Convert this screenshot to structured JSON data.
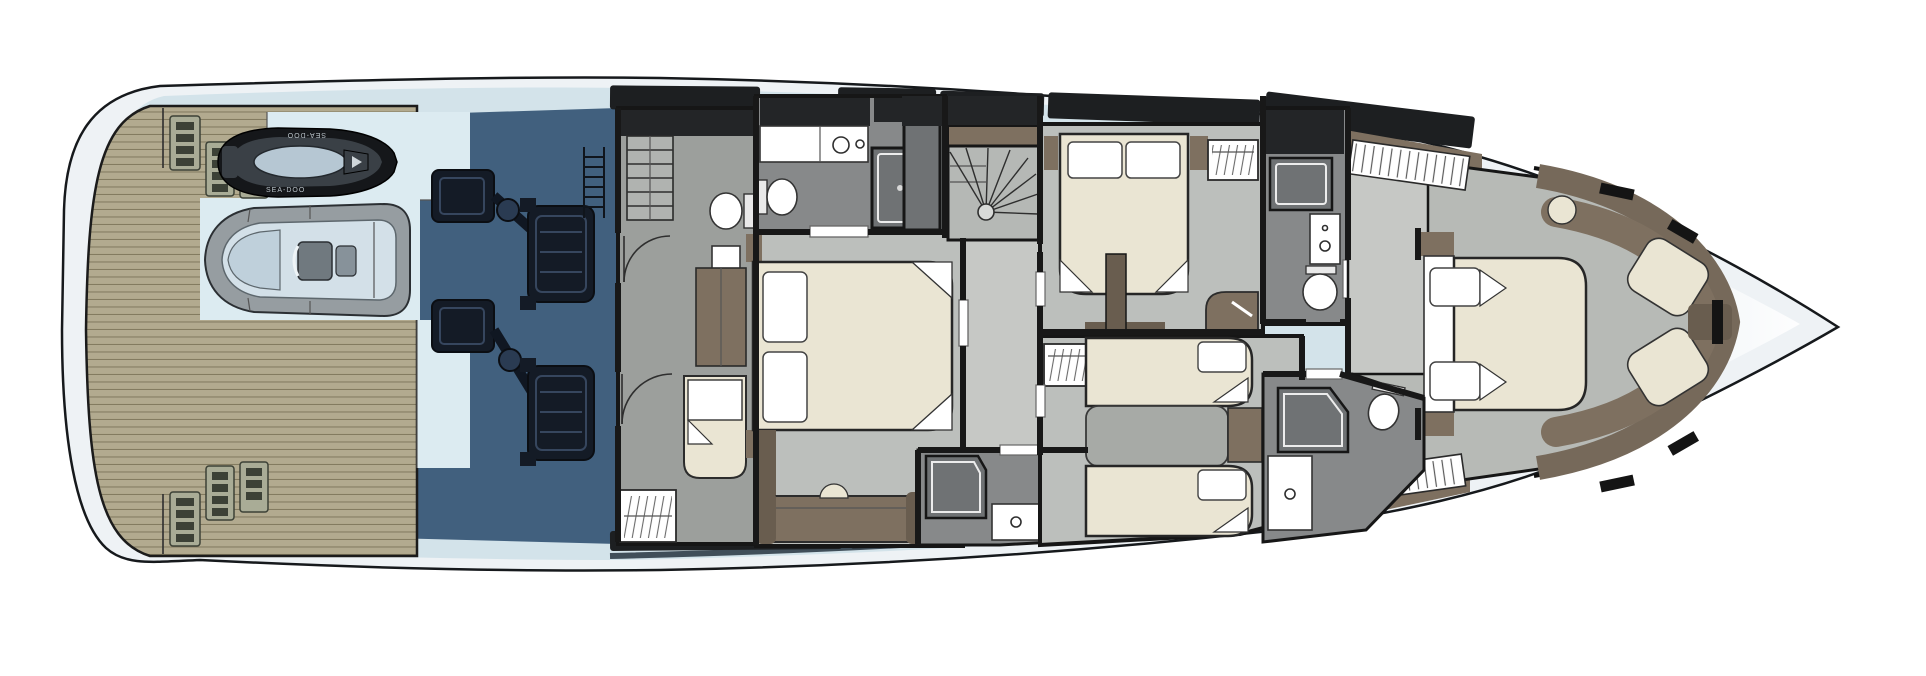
{
  "meta": {
    "title": "Yacht lower deck floor plan"
  },
  "labels": {
    "jetski_brand": "SEA-DOO"
  },
  "colors": {
    "bg": "#ffffff",
    "hull_fill": "#eef2f5",
    "hull_stroke": "#16191c",
    "deck_blue": "#d3e3ea",
    "garage_pale": "#dcebf1",
    "teak": "#b2aa8f",
    "teak_line": "#837b60",
    "louver_bg": "#a9ac96",
    "louver_slot": "#3c4136",
    "navy": "#41607e",
    "navy_dark": "#2c4257",
    "machinery": "#141b26",
    "machinery_mid": "#2a3b52",
    "jetski_black": "#15171a",
    "jetski_gray": "#3a4046",
    "jetski_seat": "#b6c7d3",
    "jetski_text": "#b9c2c8",
    "tender_tube": "#969da1",
    "tender_inner": "#d3e0e8",
    "console_gray": "#70797f",
    "floor_gray": "#9c9f9c",
    "floor_light": "#bcbfbc",
    "floor_corridor": "#c6c8c5",
    "bath_floor": "#87898a",
    "bath_dark": "#6f7274",
    "cabinet_dark": "#232527",
    "wall": "#181818",
    "brown": "#7e7060",
    "brown_dark": "#695d4f",
    "bow_brown": "#76695a",
    "cream": "#eae5d3",
    "white": "#ffffff",
    "window_band": "#1d1f21",
    "boot_stripe": "#26343f",
    "vip_floor": "#b7bab6",
    "stair_fill": "#b5b8b5",
    "bed2_gray": "#a7aaa6"
  }
}
